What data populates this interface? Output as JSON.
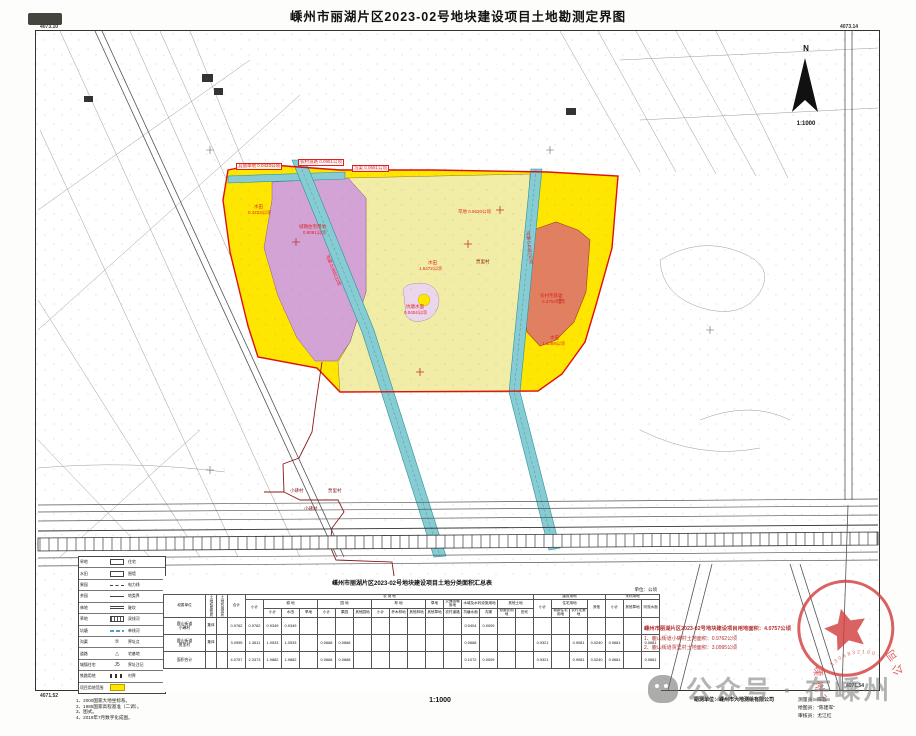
{
  "page": {
    "title": "嵊州市丽湖片区2023-02号地块建设项目土地勘测定界图",
    "scale": "1:1000",
    "north_label": "N",
    "coords": {
      "tl": "4073.10",
      "tr": "4073.14",
      "bl": "4071.52",
      "br": "4071.54"
    }
  },
  "colors": {
    "plot_yellow": "#ffe600",
    "plot_pale_yellow": "#f2eda6",
    "plot_purple": "#d4a3d6",
    "plot_salmon": "#e08060",
    "plot_pink": "#ecd6ec",
    "canal_teal": "#86ccd2",
    "boundary_red": "#dd1111",
    "village_maroon": "#8b1a1a",
    "label_red": "#d22222",
    "stamp_red": "#d24040"
  },
  "map": {
    "labels": [
      {
        "text": "其他草地 0.0423公顷",
        "x": 236,
        "y": 163,
        "box": true
      },
      {
        "text": "农村道路 0.0951公顷",
        "x": 298,
        "y": 159,
        "box": true
      },
      {
        "text": "沟渠 0.0681公顷",
        "x": 352,
        "y": 165,
        "box": true
      },
      {
        "text": "水田",
        "x": 254,
        "y": 205
      },
      {
        "text": "0.4223公顷",
        "x": 248,
        "y": 211
      },
      {
        "text": "城镇住宅用地",
        "x": 299,
        "y": 225
      },
      {
        "text": "0.9081公顷",
        "x": 303,
        "y": 231
      },
      {
        "text": "旱地 0.5520公顷",
        "x": 458,
        "y": 210
      },
      {
        "text": "水田",
        "x": 428,
        "y": 261
      },
      {
        "text": "1.6472公顷",
        "x": 419,
        "y": 267
      },
      {
        "text": "农村宅基地",
        "x": 540,
        "y": 294
      },
      {
        "text": "0.3754公顷",
        "x": 542,
        "y": 300
      },
      {
        "text": "水田",
        "x": 550,
        "y": 336
      },
      {
        "text": "1.1059公顷",
        "x": 542,
        "y": 342
      },
      {
        "text": "坑塘水面",
        "x": 406,
        "y": 305
      },
      {
        "text": "0.0404公顷",
        "x": 404,
        "y": 311
      },
      {
        "text": "沟渠 0.0681公顷",
        "x": 316,
        "y": 268,
        "rot": 68
      },
      {
        "text": "沟渠 0.0392公顷",
        "x": 512,
        "y": 245,
        "rot": 84
      },
      {
        "text": "小砩村",
        "x": 290,
        "y": 489,
        "color": "#8b1a1a"
      },
      {
        "text": "贾里村",
        "x": 328,
        "y": 489,
        "color": "#8b1a1a"
      },
      {
        "text": "小砩村",
        "x": 304,
        "y": 507,
        "color": "#8b1a1a"
      },
      {
        "text": "贾里村",
        "x": 476,
        "y": 260,
        "color": "#8b1a1a"
      }
    ]
  },
  "legend": {
    "rows": [
      {
        "left": "旱地",
        "sym": "rect",
        "right": "住宅"
      },
      {
        "left": "水田",
        "sym": "rect",
        "right": "围墙"
      },
      {
        "left": "果园",
        "sym": "dash",
        "right": "电力线"
      },
      {
        "left": "茶园",
        "sym": "line",
        "right": "地类界"
      },
      {
        "left": "林地",
        "sym": "dbl",
        "right": "陡坎"
      },
      {
        "left": "草地",
        "sym": "hatch",
        "right": "双线河"
      },
      {
        "left": "坑塘",
        "sym": "wave",
        "right": "单线河"
      },
      {
        "left": "沟渠",
        "sym": "glyph",
        "glyph": "⑤",
        "right": "界址点"
      },
      {
        "left": "道路",
        "sym": "glyph",
        "glyph": "△",
        "right": "宅基地"
      },
      {
        "left": "城镇住宅",
        "sym": "glyph",
        "glyph": "J5",
        "right": "界址注记"
      },
      {
        "left": "铁路用地",
        "sym": "rail",
        "right": "村界"
      },
      {
        "left": "项目用地范围",
        "sym": "yellow",
        "right": ""
      }
    ]
  },
  "table": {
    "title": "嵊州市丽湖片区2023-02号地块建设项目土地分类面积汇总表",
    "unit": "单位：公顷",
    "header": {
      "unit_col": "权属单位",
      "vert_cols": [
        "土地权属性质",
        "土地利用现状"
      ],
      "groups": [
        {
          "label": "合计"
        },
        {
          "label": "农  用  地",
          "subs": [
            {
              "label": "小计"
            },
            {
              "label": "耕 地",
              "leaves": [
                "小计",
                "水田",
                "旱地"
              ]
            },
            {
              "label": "园 地",
              "leaves": [
                "小计",
                "果园",
                "其他园地"
              ]
            },
            {
              "label": "林 地",
              "leaves": [
                "小计",
                "乔木林地",
                "其他林地"
              ]
            },
            {
              "label": "草地",
              "leaves": [
                "其他草地"
              ]
            },
            {
              "label": "交通运输用地",
              "leaves": [
                "农村道路"
              ]
            },
            {
              "label": "水域及水利设施用地",
              "leaves": [
                "坑塘水面",
                "沟渠"
              ]
            },
            {
              "label": "其他土地",
              "leaves": [
                "设施农用地",
                "田坎"
              ]
            }
          ]
        },
        {
          "label": "建设用地",
          "subs": [
            {
              "label": "小计"
            },
            {
              "label": "住宅用地",
              "leaves": [
                "城镇住宅用地",
                "农村宅基地"
              ]
            },
            {
              "label": "其他"
            }
          ]
        },
        {
          "label": "未利用地",
          "subs": [
            {
              "label": "小计"
            },
            {
              "label": "其他草地"
            },
            {
              "label": "河流水面"
            }
          ]
        }
      ]
    },
    "rows": [
      {
        "name": "鹿山街道小砩村",
        "nature": "集体",
        "nature2": "",
        "values": [
          "0.9762",
          "0.9762",
          "0.9349",
          "0.9349",
          "",
          "",
          "",
          "",
          "",
          "",
          "",
          "",
          "",
          "0.0404",
          "0.0009",
          "",
          "",
          "",
          "",
          "",
          "",
          "",
          "",
          ""
        ]
      },
      {
        "name": "鹿山街道贾里村",
        "nature": "集体",
        "nature2": "",
        "values": [
          "3.0995",
          "1.3611",
          "1.0533",
          "1.0533",
          "",
          "0.0668",
          "0.0668",
          "",
          "",
          "",
          "",
          "",
          "",
          "0.0668",
          "",
          "",
          "",
          "0.9321",
          "",
          "0.9081",
          "0.0240",
          "0.0681",
          "",
          "0.0681"
        ]
      },
      {
        "name": "面积合计",
        "nature": "",
        "nature2": "",
        "values": [
          "4.0757",
          "2.3373",
          "1.9882",
          "1.9882",
          "",
          "0.0668",
          "0.0668",
          "",
          "",
          "",
          "",
          "",
          "",
          "0.1072",
          "0.0009",
          "",
          "",
          "0.9321",
          "",
          "0.9081",
          "0.0240",
          "0.0681",
          "",
          "0.0681"
        ]
      }
    ]
  },
  "notes_right": {
    "lines": [
      "嵊州市丽湖片区2023-02号地块建设项目用地面积：4.0757公顷",
      "1、鹿山街道小砩村土地面积：0.9762公顷",
      "2、鹿山街道贾里村土地面积：3.0995公顷"
    ]
  },
  "notes_left": {
    "lines": [
      "1、2000国家大地坐标系。",
      "2、1985国家高程基准（二调）。",
      "3、图式。",
      "4、2019年7月数字化成图。"
    ]
  },
  "footer": {
    "survey_unit_label": "勘测单位：",
    "survey_unit": "嵊州市大地测绘有限公司",
    "crew": [
      "测量员：陈淼",
      "绘图员：\"陈建军\"",
      "审核员：尤江红"
    ]
  },
  "stamp": {
    "company": "嵊州市大地测绘有限公司",
    "number": "3306832100652"
  },
  "watermark": {
    "text": "公众号 · 在嵊州"
  }
}
